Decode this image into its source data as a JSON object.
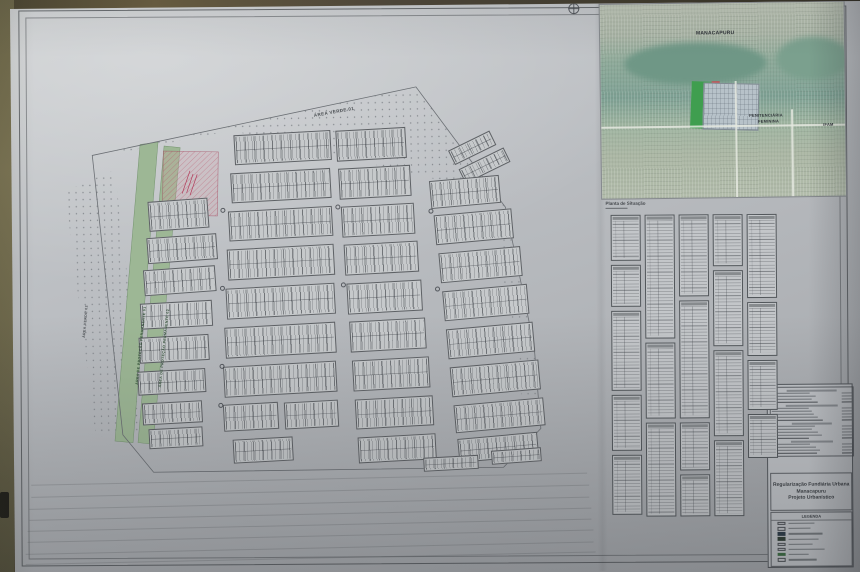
{
  "sheet": {
    "paper_color": "#b9bcc0",
    "wall_color": "#55503a",
    "accent_red": "#b23a5a",
    "accent_green": "#9db795"
  },
  "plan": {
    "labels": [
      {
        "text": "ÁREA VERDE 01",
        "x": 262,
        "y": 32,
        "rot": -9,
        "fs": 4.5,
        "cls": "lbl-dark"
      },
      {
        "text": "ÁREA VERDE 02",
        "x": 26,
        "y": 252,
        "rot": -84,
        "fs": 3.5,
        "cls": "lbl-dark"
      },
      {
        "text": "ÁREA DE PROTEÇÃO PERMANENTE 01",
        "x": 78,
        "y": 300,
        "rot": -83,
        "fs": 3.5,
        "cls": "lbl-green"
      },
      {
        "text": "ÁREA DE PROTEÇÃO PERMANENTE 02",
        "x": 101,
        "y": 303,
        "rot": -83,
        "fs": 3.5,
        "cls": "lbl-green"
      }
    ],
    "blocks": [
      [
        93,
        152,
        70,
        26,
        -3
      ],
      [
        89,
        184,
        72,
        26,
        -3
      ],
      [
        85,
        218,
        72,
        26,
        -2
      ],
      [
        83,
        252,
        70,
        26,
        -2
      ],
      [
        81,
        286,
        68,
        24,
        -2
      ],
      [
        85,
        318,
        60,
        22,
        -2
      ],
      [
        91,
        344,
        54,
        20,
        -2
      ],
      [
        95,
        116,
        60,
        30,
        -3
      ],
      [
        182,
        51,
        97,
        30,
        -2
      ],
      [
        178,
        89,
        100,
        30,
        -2
      ],
      [
        175,
        127,
        104,
        30,
        -2
      ],
      [
        173,
        165,
        107,
        31,
        -2
      ],
      [
        171,
        204,
        109,
        31,
        -2
      ],
      [
        169,
        243,
        111,
        31,
        -2
      ],
      [
        167,
        282,
        113,
        31,
        -2
      ],
      [
        166,
        321,
        55,
        27,
        -2
      ],
      [
        227,
        320,
        54,
        27,
        -2
      ],
      [
        175,
        356,
        60,
        24,
        -2
      ],
      [
        284,
        49,
        70,
        31,
        -2
      ],
      [
        286,
        87,
        72,
        31,
        -2
      ],
      [
        288,
        125,
        73,
        31,
        -2
      ],
      [
        290,
        163,
        74,
        31,
        -2
      ],
      [
        292,
        202,
        75,
        31,
        -2
      ],
      [
        294,
        240,
        76,
        31,
        -2
      ],
      [
        296,
        279,
        77,
        31,
        -2
      ],
      [
        298,
        318,
        78,
        30,
        -2
      ],
      [
        300,
        356,
        78,
        26,
        -2
      ],
      [
        397,
        62,
        46,
        16,
        -25
      ],
      [
        407,
        80,
        50,
        16,
        -25
      ],
      [
        377,
        100,
        70,
        28,
        -4
      ],
      [
        381,
        134,
        78,
        30,
        -4
      ],
      [
        385,
        172,
        82,
        30,
        -4
      ],
      [
        388,
        210,
        85,
        30,
        -4
      ],
      [
        391,
        248,
        87,
        30,
        -4
      ],
      [
        394,
        286,
        89,
        30,
        -4
      ],
      [
        397,
        324,
        90,
        28,
        -4
      ],
      [
        400,
        358,
        80,
        24,
        -4
      ],
      [
        365,
        378,
        55,
        14,
        -2
      ],
      [
        433,
        372,
        50,
        14,
        -3
      ]
    ],
    "junctions": [
      [
        167,
        125
      ],
      [
        165,
        203
      ],
      [
        163,
        281
      ],
      [
        282,
        124
      ],
      [
        286,
        202
      ],
      [
        375,
        130
      ],
      [
        380,
        208
      ],
      [
        161,
        320
      ]
    ],
    "floor_lines": [
      [
        30,
        478,
        556
      ],
      [
        30,
        490,
        558
      ],
      [
        28,
        502,
        560
      ],
      [
        28,
        513,
        562
      ],
      [
        26,
        524,
        564
      ],
      [
        26,
        535,
        566
      ],
      [
        24,
        547,
        568
      ],
      [
        24,
        557,
        570
      ]
    ]
  },
  "inset": {
    "caption": "Planta de Situação",
    "labels": [
      {
        "text": "MANACAPURU",
        "x": 96,
        "y": 27,
        "fs": 5
      },
      {
        "text": "PENITENCIÁRIA",
        "x": 148,
        "y": 110,
        "fs": 4
      },
      {
        "text": "FEMININA",
        "x": 157,
        "y": 116,
        "fs": 4
      },
      {
        "text": "IFAM",
        "x": 222,
        "y": 120,
        "fs": 4
      }
    ]
  },
  "tables": {
    "columns": [
      {
        "x": 611,
        "w": 30,
        "segments": [
          [
            216,
            46
          ],
          [
            266,
            42
          ],
          [
            312,
            80
          ],
          [
            396,
            56
          ],
          [
            456,
            60
          ]
        ]
      },
      {
        "x": 645,
        "w": 30,
        "segments": [
          [
            216,
            124
          ],
          [
            344,
            76
          ],
          [
            424,
            94
          ]
        ]
      },
      {
        "x": 679,
        "w": 30,
        "segments": [
          [
            216,
            82
          ],
          [
            302,
            118
          ],
          [
            424,
            48
          ],
          [
            476,
            42
          ]
        ]
      },
      {
        "x": 713,
        "w": 30,
        "segments": [
          [
            216,
            52
          ],
          [
            272,
            76
          ],
          [
            352,
            86
          ],
          [
            442,
            76
          ]
        ]
      },
      {
        "x": 747,
        "w": 30,
        "segments": [
          [
            216,
            84
          ],
          [
            304,
            54
          ],
          [
            362,
            50
          ],
          [
            416,
            44
          ]
        ]
      }
    ]
  },
  "title_block": {
    "line1": "Regularização Fundiária Urbana",
    "line2": "Manacapuru",
    "line3": "Projeto Urbanístico",
    "legend_title": "LEGENDA",
    "summary_rows": [
      62,
      48,
      55,
      50,
      58,
      66,
      46,
      50,
      52,
      58,
      64,
      50,
      54,
      50,
      58,
      62,
      46,
      52,
      48,
      55,
      60,
      56
    ],
    "summary_head_rows": [
      0,
      5,
      11,
      17
    ],
    "summary_total_rows": [
      4,
      10,
      16,
      21
    ],
    "legend_items": [
      {
        "swatch": "sw-outline",
        "w": 26
      },
      {
        "swatch": "sw-outline",
        "w": 22
      },
      {
        "swatch": "sw-navy",
        "w": 34
      },
      {
        "swatch": "sw-dark",
        "w": 30
      },
      {
        "swatch": "sw-outline",
        "w": 24
      },
      {
        "swatch": "sw-outline",
        "w": 36
      },
      {
        "swatch": "sw-green",
        "w": 20
      },
      {
        "swatch": "sw-outline",
        "w": 28
      }
    ]
  }
}
